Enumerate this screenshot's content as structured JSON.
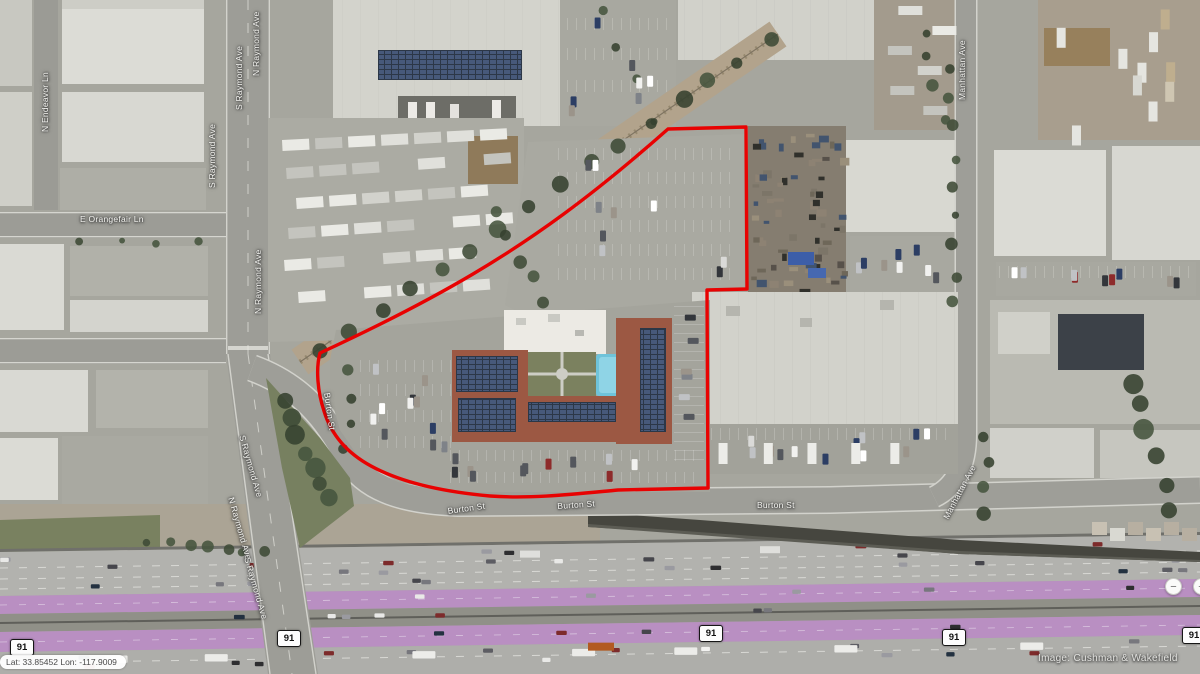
{
  "map": {
    "labels": {
      "e_orangefair": "E Orangefair Ln",
      "n_endeavor": "N Endeavor Ln",
      "s_raymond": "S Raymond Ave",
      "n_raymond": "N Raymond Ave",
      "burton": "Burton St",
      "manhattan": "Manhattan Ave"
    },
    "route_shield": "91",
    "coordinates": "Lat: 33.85452 Lon: -117.9009",
    "attribution": "Image: Cushman & Wakefield",
    "controls": {
      "zoom_out": "−",
      "zoom_in": "+"
    },
    "colors": {
      "parcel_outline": "#e80202",
      "toll_lane_overlay": "#b98fc2",
      "pool": "#6fc3da",
      "terracotta_roof": "#9c5843"
    }
  }
}
